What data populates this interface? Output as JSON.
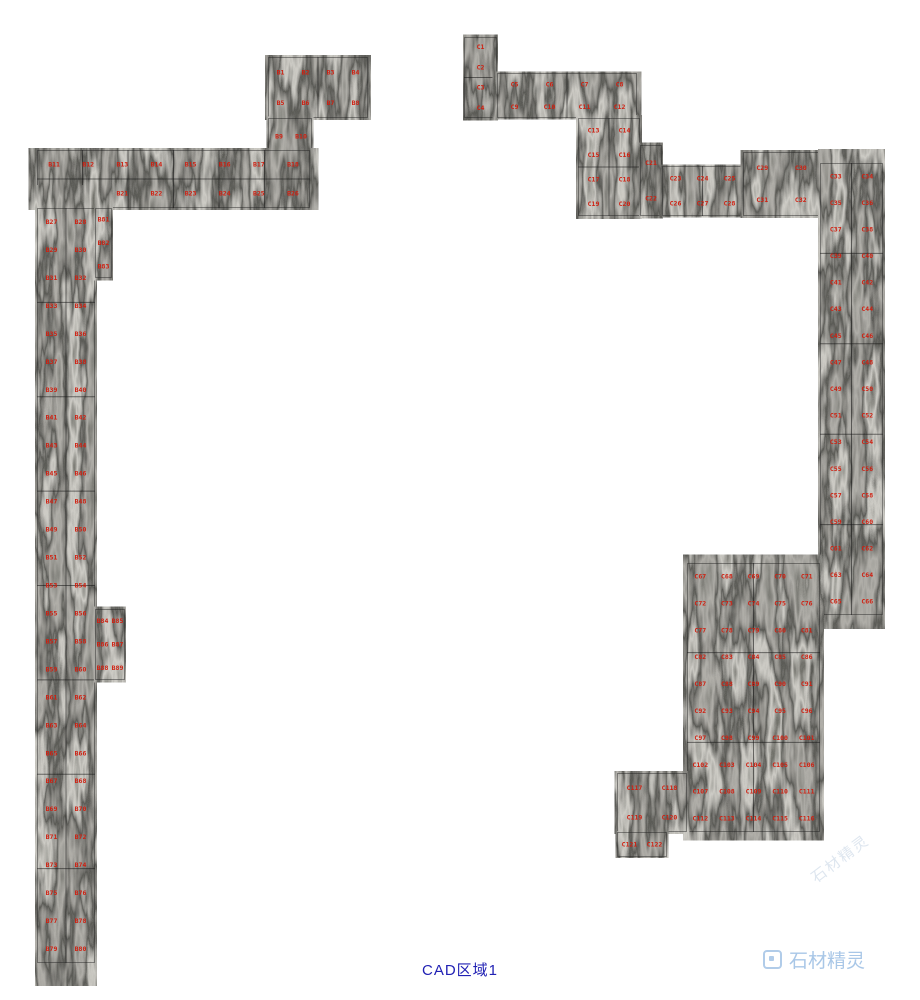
{
  "canvas": {
    "width": 920,
    "height": 1000,
    "background": "#ffffff"
  },
  "caption": {
    "text": "CAD区域1",
    "color": "#2121b4"
  },
  "watermark": {
    "text": "石材精灵",
    "color": "#a9c7e7",
    "ghost_color": "#b7c9dd"
  },
  "texture": {
    "mid": "#55534e",
    "dark": "#1a1a18",
    "light": "#8f8d86",
    "seam": "#141414",
    "edge": "#20201e"
  },
  "label_style": {
    "color": "#d01f10",
    "size_px": 6.5
  },
  "regions": [
    {
      "id": "top-left-block",
      "x": 268,
      "y": 57,
      "w": 100,
      "h": 61,
      "cols": 4,
      "tcols": 2,
      "trows": 1,
      "labels": [
        "B1",
        "B2",
        "B3",
        "B4",
        "B5",
        "B6",
        "B7",
        "B8"
      ]
    },
    {
      "id": "top-left-small",
      "x": 268,
      "y": 118,
      "w": 44,
      "h": 37,
      "cols": 2,
      "tcols": 1,
      "trows": 1,
      "labels": [
        "B9",
        "B10"
      ]
    },
    {
      "id": "left-band",
      "x": 37,
      "y": 150,
      "w": 273,
      "h": 58,
      "cols": 8,
      "tcols": 6,
      "trows": 2,
      "labels": [
        "B11",
        "B12",
        "B13",
        "B14",
        "B15",
        "B16",
        "B17",
        "B18",
        "B19",
        "B20",
        "B21",
        "B22",
        "B23",
        "B24",
        "B25",
        "B26"
      ]
    },
    {
      "id": "left-strip",
      "x": 37,
      "y": 208,
      "w": 58,
      "h": 755,
      "cols": 2,
      "tcols": 2,
      "trows": 8,
      "labels": [
        "B27",
        "B28",
        "B29",
        "B30",
        "B31",
        "B32",
        "B33",
        "B34",
        "B35",
        "B36",
        "B37",
        "B38",
        "B39",
        "B40",
        "B41",
        "B42",
        "B43",
        "B44",
        "B45",
        "B46",
        "B47",
        "B48",
        "B49",
        "B50",
        "B51",
        "B52",
        "B53",
        "B54",
        "B55",
        "B56",
        "B57",
        "B58",
        "B59",
        "B60",
        "B61",
        "B62",
        "B63",
        "B64",
        "B65",
        "B66",
        "B67",
        "B68",
        "B69",
        "B70",
        "B71",
        "B72",
        "B73",
        "B74",
        "B75",
        "B76",
        "B77",
        "B78",
        "B79",
        "B80"
      ]
    },
    {
      "id": "left-stub",
      "x": 95,
      "y": 208,
      "w": 17,
      "h": 70,
      "cols": 1,
      "tcols": 1,
      "trows": 1,
      "labels": [
        "B81",
        "B82",
        "B83"
      ]
    },
    {
      "id": "left-bump",
      "x": 95,
      "y": 609,
      "w": 30,
      "h": 71,
      "cols": 2,
      "tcols": 1,
      "trows": 1,
      "labels": [
        "B84",
        "B85",
        "B86",
        "B87",
        "B88",
        "B89"
      ]
    },
    {
      "id": "right-top-tile",
      "x": 464,
      "y": 37,
      "w": 33,
      "h": 81,
      "cols": 1,
      "tcols": 1,
      "trows": 2,
      "labels": [
        "C1",
        "C2",
        "C3",
        "C4"
      ]
    },
    {
      "id": "right-top-row",
      "x": 497,
      "y": 73,
      "w": 140,
      "h": 45,
      "cols": 4,
      "tcols": 2,
      "trows": 1,
      "labels": [
        "C5",
        "C6",
        "C7",
        "C8",
        "C9",
        "C10",
        "C11",
        "C12"
      ]
    },
    {
      "id": "right-col",
      "x": 578,
      "y": 118,
      "w": 62,
      "h": 98,
      "cols": 2,
      "tcols": 2,
      "trows": 2,
      "labels": [
        "C13",
        "C14",
        "C15",
        "C16",
        "C17",
        "C18",
        "C19",
        "C20"
      ]
    },
    {
      "id": "right-step",
      "x": 640,
      "y": 145,
      "w": 22,
      "h": 71,
      "cols": 1,
      "tcols": 1,
      "trows": 1,
      "labels": [
        "C21",
        "C22"
      ]
    },
    {
      "id": "right-band-mid",
      "x": 662,
      "y": 166,
      "w": 81,
      "h": 50,
      "cols": 3,
      "tcols": 2,
      "trows": 1,
      "labels": [
        "C23",
        "C24",
        "C25",
        "C26",
        "C27",
        "C28"
      ]
    },
    {
      "id": "right-band",
      "x": 743,
      "y": 152,
      "w": 77,
      "h": 64,
      "cols": 2,
      "tcols": 1,
      "trows": 1,
      "labels": [
        "C29",
        "C30",
        "C31",
        "C32"
      ]
    },
    {
      "id": "right-strip",
      "x": 820,
      "y": 163,
      "w": 63,
      "h": 452,
      "cols": 2,
      "tcols": 2,
      "trows": 5,
      "labels": [
        "C33",
        "C34",
        "C35",
        "C36",
        "C37",
        "C38",
        "C39",
        "C40",
        "C41",
        "C42",
        "C43",
        "C44",
        "C45",
        "C46",
        "C47",
        "C48",
        "C49",
        "C50",
        "C51",
        "C52",
        "C53",
        "C54",
        "C55",
        "C56",
        "C57",
        "C58",
        "C59",
        "C60",
        "C61",
        "C62",
        "C63",
        "C64",
        "C65",
        "C66"
      ]
    },
    {
      "id": "bottom-right-block",
      "x": 687,
      "y": 563,
      "w": 133,
      "h": 269,
      "cols": 5,
      "tcols": 2,
      "trows": 3,
      "labels": [
        "C67",
        "C68",
        "C69",
        "C70",
        "C71",
        "C72",
        "C73",
        "C74",
        "C75",
        "C76",
        "C77",
        "C78",
        "C79",
        "C80",
        "C81",
        "C82",
        "C83",
        "C84",
        "C85",
        "C86",
        "C87",
        "C88",
        "C89",
        "C90",
        "C91",
        "C92",
        "C93",
        "C94",
        "C95",
        "C96",
        "C97",
        "C98",
        "C99",
        "C100",
        "C101",
        "C102",
        "C103",
        "C104",
        "C105",
        "C106",
        "C107",
        "C108",
        "C109",
        "C110",
        "C111",
        "C112",
        "C113",
        "C114",
        "C115",
        "C116"
      ]
    },
    {
      "id": "bottom-right-ext",
      "x": 617,
      "y": 773,
      "w": 70,
      "h": 59,
      "cols": 2,
      "tcols": 1,
      "trows": 1,
      "labels": [
        "C117",
        "C118",
        "C119",
        "C120"
      ]
    },
    {
      "id": "bottom-right-stub",
      "x": 617,
      "y": 832,
      "w": 50,
      "h": 25,
      "cols": 2,
      "tcols": 1,
      "trows": 1,
      "labels": [
        "C121",
        "C122"
      ]
    }
  ]
}
